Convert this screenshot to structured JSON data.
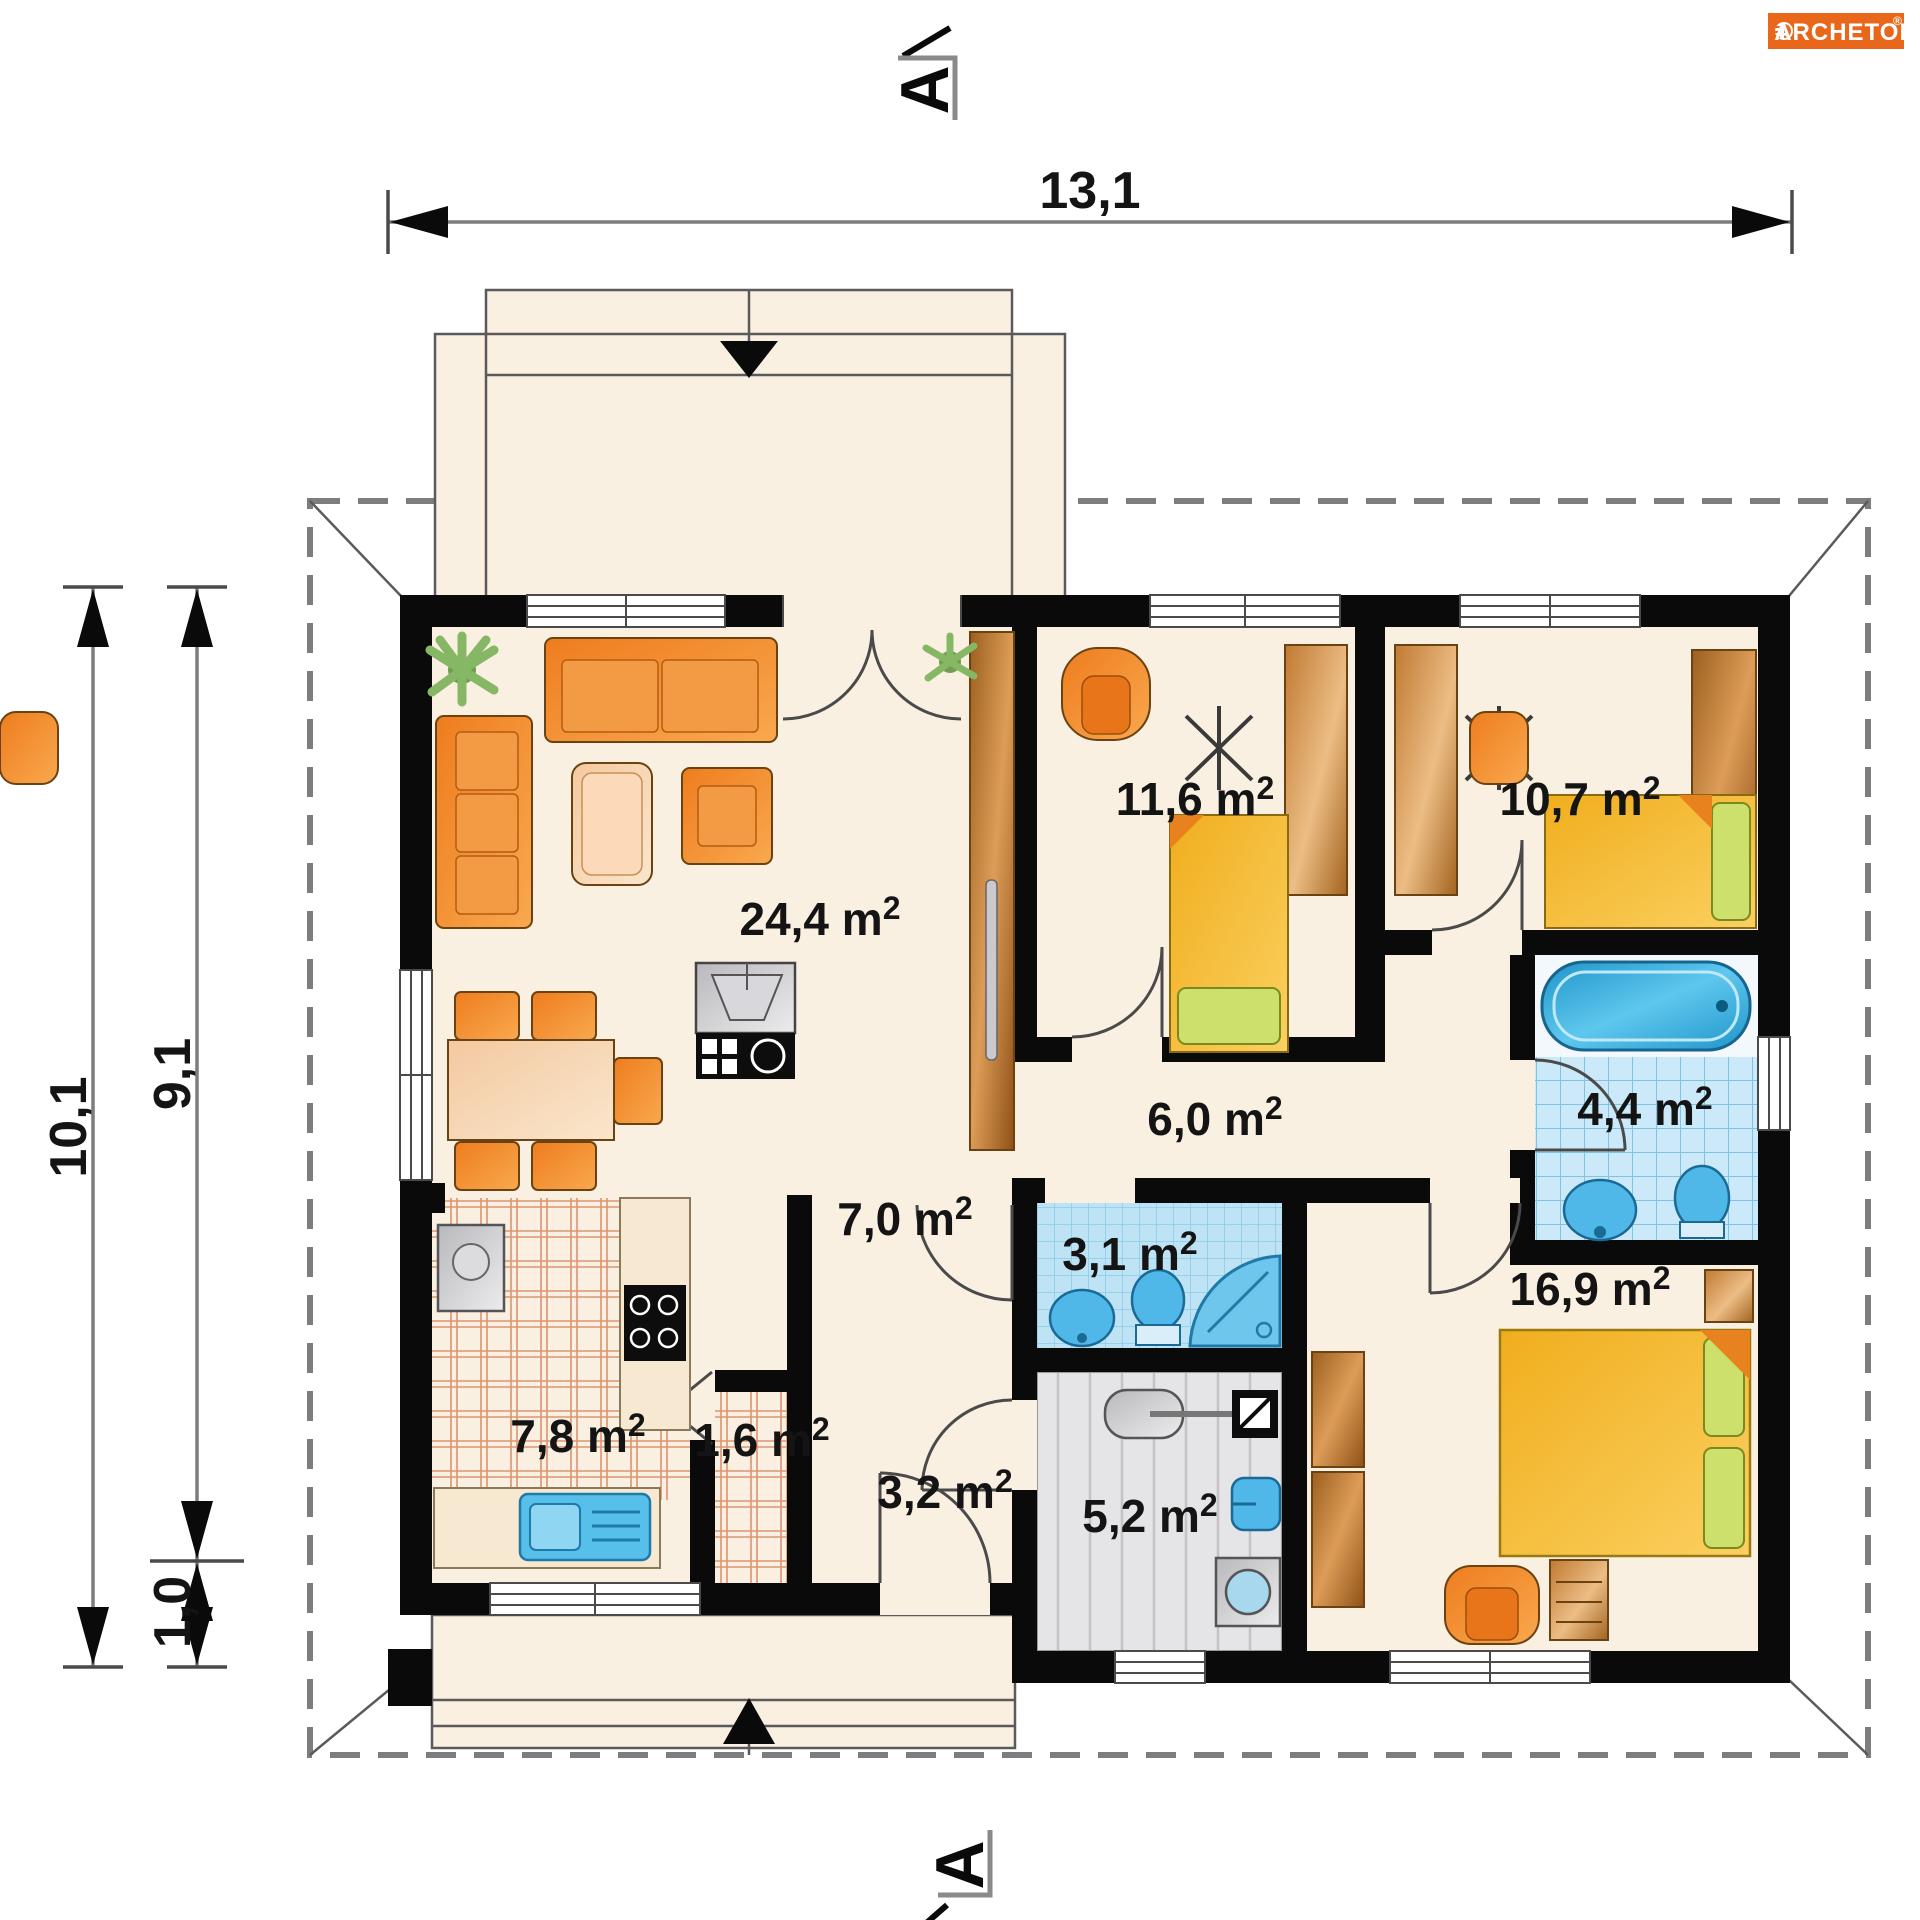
{
  "logo": {
    "brand": "ARCHETON",
    "registered": "®"
  },
  "section_marker": {
    "top": "A",
    "bottom": "A"
  },
  "dimensions": {
    "total_width": "13,1",
    "total_depth": "10,1",
    "house_depth": "9,1",
    "terrace_depth": "1,0"
  },
  "unit_sup": "2",
  "rooms": {
    "living_room": {
      "label": "24,4 m"
    },
    "bedroom_top": {
      "label": "11,6 m"
    },
    "bedroom_right": {
      "label": "10,7 m"
    },
    "bathroom": {
      "label": "4,4 m"
    },
    "corridor": {
      "label": "6,0 m"
    },
    "hall": {
      "label": "7,0 m"
    },
    "wc": {
      "label": "3,1 m"
    },
    "bedroom_main": {
      "label": "16,9 m"
    },
    "kitchen": {
      "label": "7,8 m"
    },
    "pantry": {
      "label": "1,6 m"
    },
    "vestibule": {
      "label": "3,2 m"
    },
    "utility": {
      "label": "5,2 m"
    }
  },
  "colors": {
    "accent_orange": "#E8671B",
    "wall": "#0A0A0A",
    "floor_cream": "#FAF0E2",
    "tile_blue": "#BFE4F5",
    "furniture_orange": "#F08428",
    "wood_brown": "#B06F2E",
    "bed_yellow": "#F5B930",
    "utility_gray": "#E4E4E6"
  }
}
